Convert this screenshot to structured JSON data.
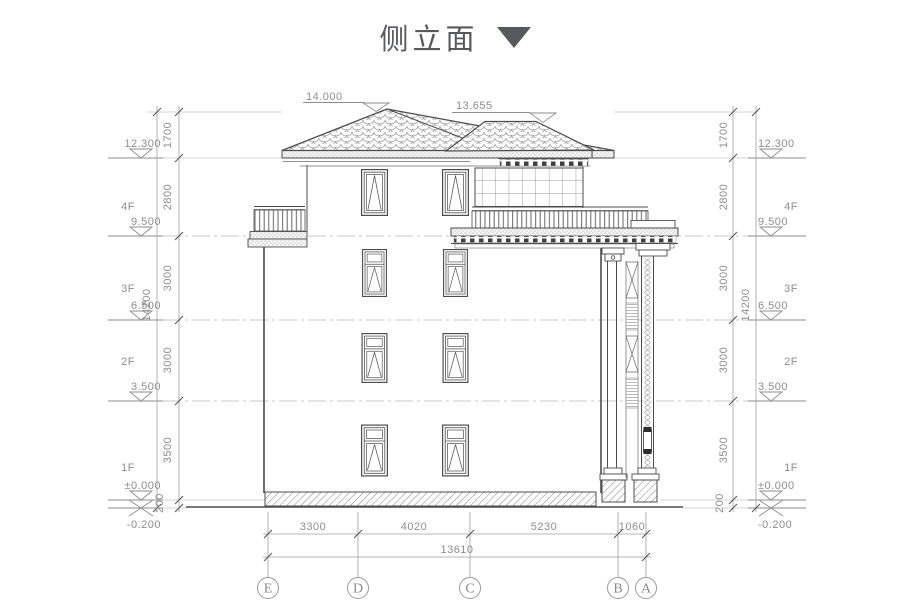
{
  "title": {
    "text": "侧立面"
  },
  "colors": {
    "line": "#4d4d4d",
    "dim_text": "#8e8e8e",
    "dim_line": "#a0a0a0",
    "level_line": "#c9c9c9",
    "title": "#58595c"
  },
  "annotations": {
    "ridge_main": "14.000",
    "ridge_secondary": "13.655"
  },
  "floors": {
    "f4": "4F",
    "f3": "3F",
    "f2": "2F",
    "f1": "1F"
  },
  "elevations": {
    "roof": "12.300",
    "f4": "9.500",
    "f3": "6.500",
    "f2": "3.500",
    "f1": "±0.000",
    "ground": "-0.200"
  },
  "vertical_dims": {
    "seg1": "1700",
    "seg2": "2800",
    "seg3": "3000",
    "seg4": "3000",
    "seg5": "3500",
    "seg6": "200",
    "total": "14200"
  },
  "horizontal_dims": {
    "seg1": "3300",
    "seg2": "4020",
    "seg3": "5230",
    "seg4": "1060",
    "total": "13610"
  },
  "grid_axes": {
    "e": "E",
    "d": "D",
    "c": "C",
    "b": "B",
    "a": "A"
  }
}
